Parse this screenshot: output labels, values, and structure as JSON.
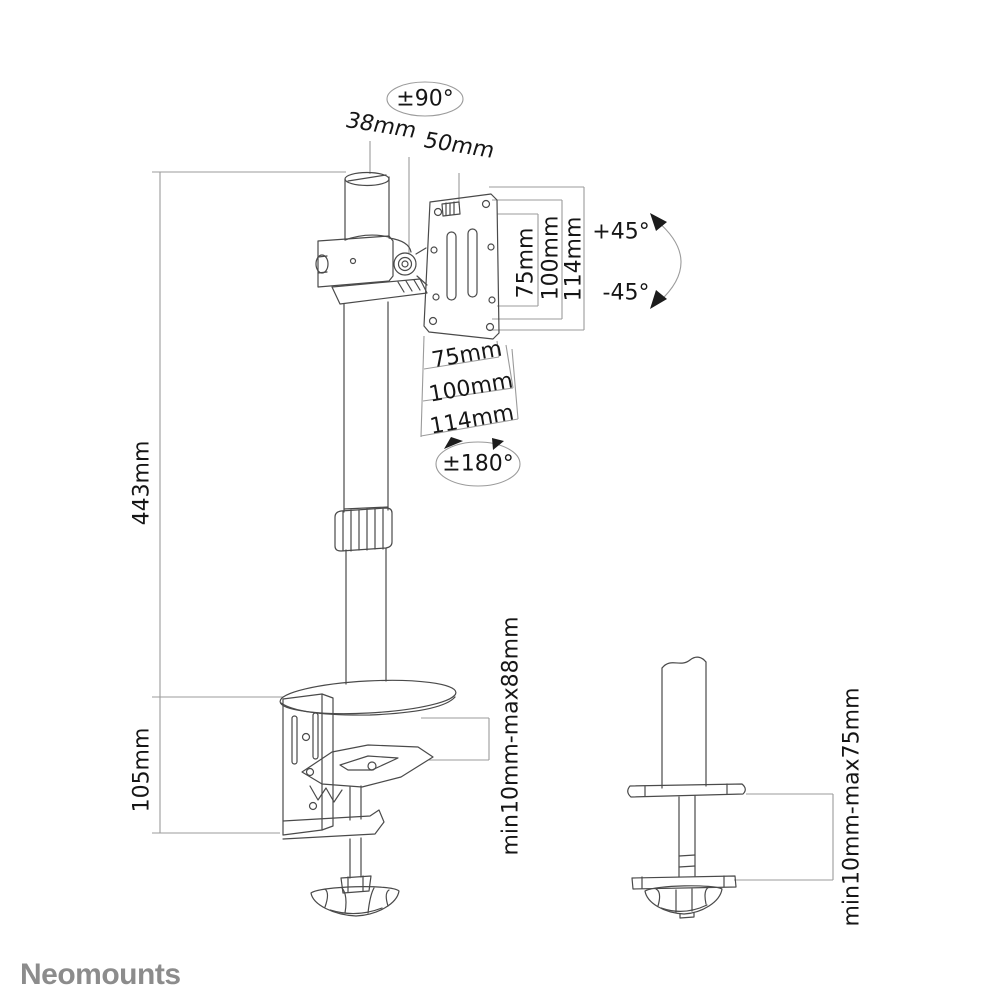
{
  "page": {
    "background": "#ffffff"
  },
  "brand": {
    "logo_text": "Neomounts",
    "logo_color": "#8c8c8c"
  },
  "drawing": {
    "object_line_color": "#4a4a4a",
    "dimension_line_color": "#9b9b9b",
    "label_color": "#161616",
    "arrow_color": "#1c1c1c"
  },
  "annotations": {
    "pole_rotation": "±90°",
    "pole_diameter": "38mm",
    "head_offset": "50mm",
    "tilt_up": "+45°",
    "tilt_down": "-45°",
    "swivel": "±180°",
    "vesa_vertical": {
      "v75": "75mm",
      "v100": "100mm",
      "v114": "114mm"
    },
    "vesa_horizontal": {
      "h75": "75mm",
      "h100": "100mm",
      "h114": "114mm"
    },
    "pole_height": "443mm",
    "clamp_height": "105mm",
    "clamp_thickness_range": "min10mm-max88mm",
    "grommet_thickness_range": "min10mm-max75mm"
  }
}
